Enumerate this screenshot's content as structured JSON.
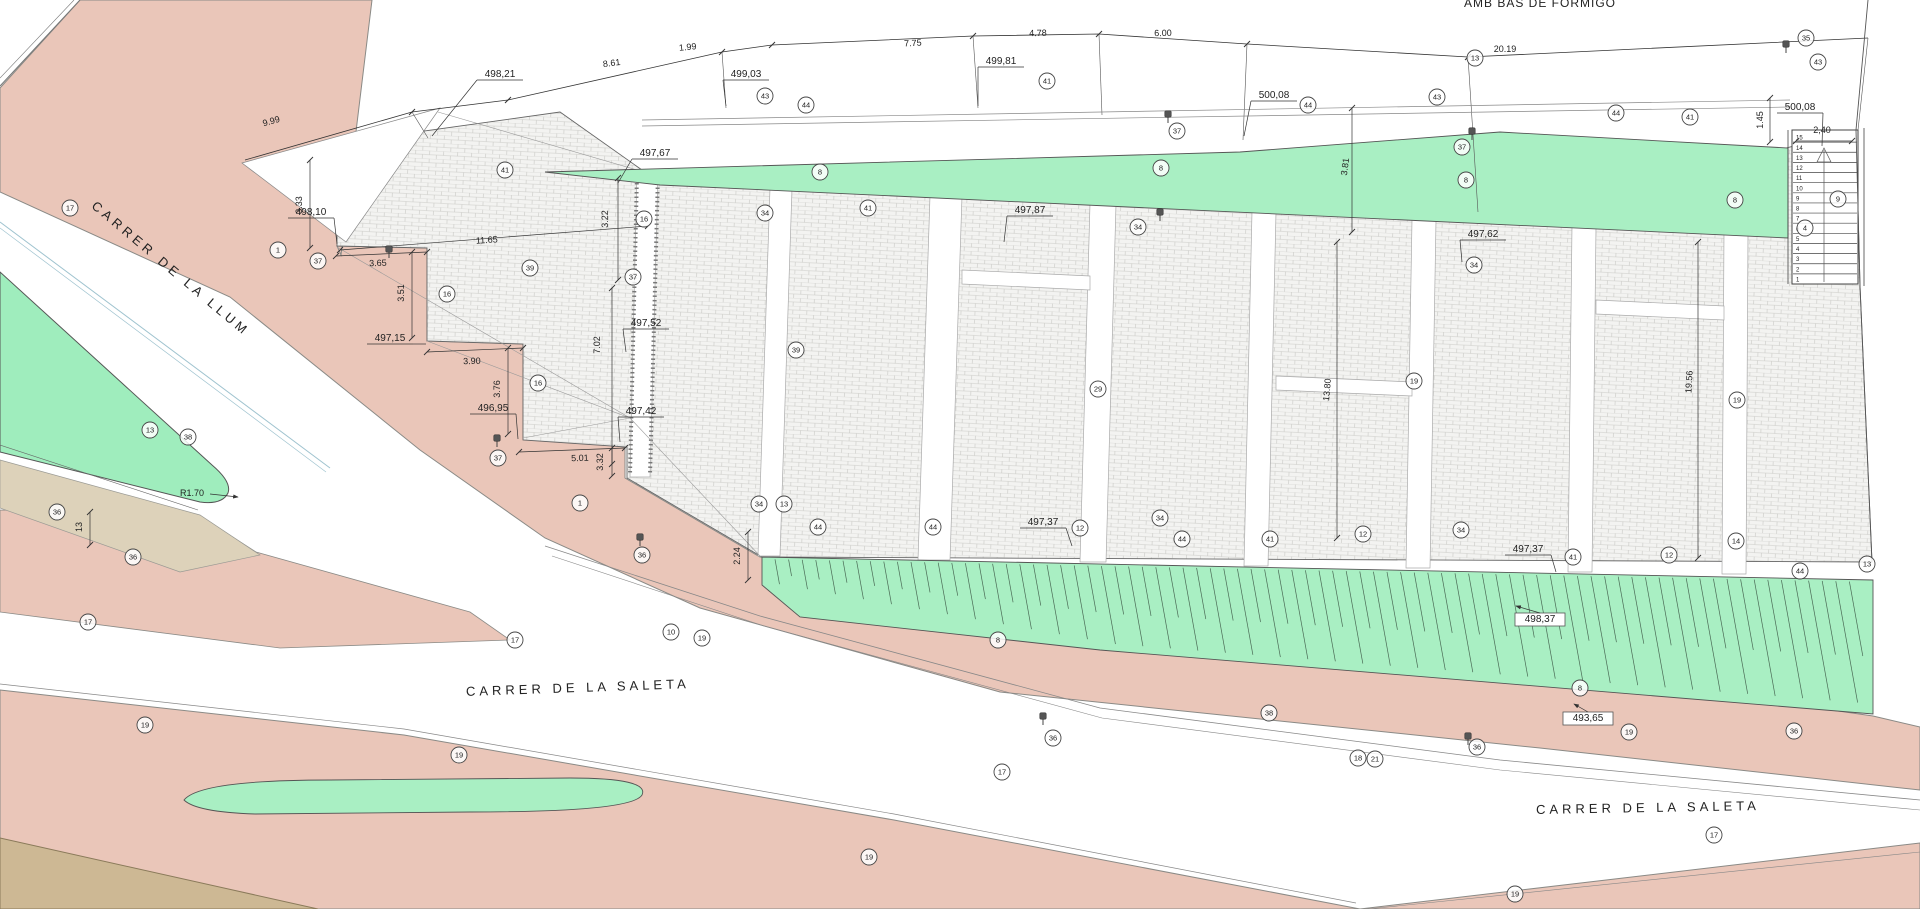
{
  "note_top_right": "AMB BAS DE FORMIGO",
  "radius_label": "R1.70",
  "street_names": [
    {
      "text": "CARRER  DE  LA  LLUM",
      "x": 168,
      "y": 272,
      "rot": 40
    },
    {
      "text": "CARRER  DE  LA  SALETA",
      "x": 578,
      "y": 692,
      "rot": -2
    },
    {
      "text": "CARRER  DE  LA  SALETA",
      "x": 1648,
      "y": 812,
      "rot": -1
    }
  ],
  "dimensions": [
    {
      "t": "9.99",
      "x": 272,
      "y": 124,
      "r": -16
    },
    {
      "t": "8.61",
      "x": 612,
      "y": 66,
      "r": -7
    },
    {
      "t": "1.99",
      "x": 688,
      "y": 50,
      "r": -6
    },
    {
      "t": "7.75",
      "x": 913,
      "y": 46,
      "r": -3
    },
    {
      "t": "4.78",
      "x": 1038,
      "y": 36,
      "r": -1
    },
    {
      "t": "6.00",
      "x": 1163,
      "y": 36,
      "r": -1
    },
    {
      "t": "20.19",
      "x": 1505,
      "y": 52,
      "r": 0
    },
    {
      "t": "3.33",
      "x": 302,
      "y": 205,
      "r": -90,
      "l": [
        310,
        160,
        310,
        248
      ]
    },
    {
      "t": "3.65",
      "x": 378,
      "y": 266,
      "r": -2,
      "l": [
        336,
        256,
        427,
        252
      ]
    },
    {
      "t": "11.65",
      "x": 487,
      "y": 243,
      "r": -4,
      "l": [
        340,
        250,
        648,
        226
      ]
    },
    {
      "t": "3.51",
      "x": 404,
      "y": 293,
      "r": -90,
      "l": [
        412,
        252,
        412,
        338
      ]
    },
    {
      "t": "3.90",
      "x": 472,
      "y": 364,
      "r": -2,
      "l": [
        427,
        352,
        523,
        348
      ]
    },
    {
      "t": "3.76",
      "x": 500,
      "y": 389,
      "r": -90,
      "l": [
        508,
        348,
        508,
        434
      ]
    },
    {
      "t": "5.01",
      "x": 580,
      "y": 461,
      "r": -2,
      "l": [
        519,
        452,
        625,
        448
      ]
    },
    {
      "t": "3.32",
      "x": 603,
      "y": 462,
      "r": -90,
      "l": [
        612,
        448,
        612,
        476
      ]
    },
    {
      "t": "3.22",
      "x": 608,
      "y": 219,
      "r": -90,
      "l": [
        618,
        178,
        618,
        280
      ]
    },
    {
      "t": "7.02",
      "x": 600,
      "y": 345,
      "r": -90,
      "l": [
        612,
        288,
        612,
        464
      ]
    },
    {
      "t": "2.24",
      "x": 740,
      "y": 556,
      "r": -90,
      "l": [
        748,
        532,
        748,
        580
      ]
    },
    {
      "t": "3.81",
      "x": 1348,
      "y": 167,
      "r": -83,
      "l": [
        1352,
        108,
        1352,
        232
      ]
    },
    {
      "t": "13.80",
      "x": 1330,
      "y": 390,
      "r": -85,
      "l": [
        1337,
        242,
        1337,
        538
      ]
    },
    {
      "t": "19.56",
      "x": 1692,
      "y": 382,
      "r": -87,
      "l": [
        1698,
        242,
        1698,
        558
      ]
    },
    {
      "t": "1.45",
      "x": 1763,
      "y": 120,
      "r": -90,
      "l": [
        1770,
        98,
        1770,
        142
      ]
    },
    {
      "t": "2,40",
      "x": 1822,
      "y": 133,
      "r": 0,
      "l": [
        1796,
        141,
        1852,
        141
      ]
    },
    {
      "t": "13",
      "x": 82,
      "y": 527,
      "r": -90,
      "l": [
        90,
        512,
        90,
        545
      ]
    }
  ],
  "elevations": [
    {
      "t": "498,21",
      "x": 500,
      "y": 77,
      "lx": 432,
      "ly": 136
    },
    {
      "t": "499,03",
      "x": 746,
      "y": 77,
      "lx": 726,
      "ly": 106
    },
    {
      "t": "499,81",
      "x": 1001,
      "y": 64,
      "lx": 978,
      "ly": 106
    },
    {
      "t": "500,08",
      "x": 1274,
      "y": 98,
      "lx": 1244,
      "ly": 136
    },
    {
      "t": "500,08",
      "x": 1800,
      "y": 110,
      "lx": 1822,
      "ly": 146
    },
    {
      "t": "498,10",
      "x": 311,
      "y": 215,
      "lx": 337,
      "ly": 244
    },
    {
      "t": "497,15",
      "x": 390,
      "y": 341,
      "lx": 426,
      "ly": 344
    },
    {
      "t": "496,95",
      "x": 493,
      "y": 411,
      "lx": 518,
      "ly": 439
    },
    {
      "t": "497,67",
      "x": 655,
      "y": 156,
      "lx": 618,
      "ly": 183
    },
    {
      "t": "497,52",
      "x": 646,
      "y": 326,
      "lx": 626,
      "ly": 352
    },
    {
      "t": "497,42",
      "x": 641,
      "y": 414,
      "lx": 620,
      "ly": 442
    },
    {
      "t": "497,87",
      "x": 1030,
      "y": 213,
      "lx": 1004,
      "ly": 242
    },
    {
      "t": "497,62",
      "x": 1483,
      "y": 237,
      "lx": 1462,
      "ly": 262
    },
    {
      "t": "497,37",
      "x": 1043,
      "y": 525,
      "lx": 1072,
      "ly": 546
    },
    {
      "t": "497,37",
      "x": 1528,
      "y": 552,
      "lx": 1556,
      "ly": 572
    },
    {
      "t": "498,37",
      "x": 1540,
      "y": 622,
      "lx": 1516,
      "ly": 606,
      "boxed": true
    },
    {
      "t": "493,65",
      "x": 1588,
      "y": 721,
      "lx": 1574,
      "ly": 704,
      "boxed": true
    }
  ],
  "keynotes": [
    {
      "n": "17",
      "x": 70,
      "y": 208
    },
    {
      "n": "17",
      "x": 88,
      "y": 622
    },
    {
      "n": "17",
      "x": 515,
      "y": 640
    },
    {
      "n": "17",
      "x": 1002,
      "y": 772
    },
    {
      "n": "17",
      "x": 1714,
      "y": 835
    },
    {
      "n": "1",
      "x": 278,
      "y": 250
    },
    {
      "n": "1",
      "x": 580,
      "y": 503
    },
    {
      "n": "37",
      "x": 318,
      "y": 261
    },
    {
      "n": "37",
      "x": 498,
      "y": 458
    },
    {
      "n": "37",
      "x": 633,
      "y": 277
    },
    {
      "n": "37",
      "x": 1177,
      "y": 131
    },
    {
      "n": "37",
      "x": 1462,
      "y": 147
    },
    {
      "n": "43",
      "x": 765,
      "y": 96
    },
    {
      "n": "43",
      "x": 1437,
      "y": 97
    },
    {
      "n": "43",
      "x": 1818,
      "y": 62
    },
    {
      "n": "44",
      "x": 806,
      "y": 105
    },
    {
      "n": "44",
      "x": 1308,
      "y": 105
    },
    {
      "n": "44",
      "x": 1616,
      "y": 113
    },
    {
      "n": "44",
      "x": 818,
      "y": 527
    },
    {
      "n": "44",
      "x": 933,
      "y": 527
    },
    {
      "n": "44",
      "x": 1182,
      "y": 539
    },
    {
      "n": "44",
      "x": 1800,
      "y": 571
    },
    {
      "n": "41",
      "x": 505,
      "y": 170
    },
    {
      "n": "41",
      "x": 1047,
      "y": 81
    },
    {
      "n": "41",
      "x": 1690,
      "y": 117
    },
    {
      "n": "41",
      "x": 868,
      "y": 208
    },
    {
      "n": "41",
      "x": 1270,
      "y": 539
    },
    {
      "n": "41",
      "x": 1573,
      "y": 557
    },
    {
      "n": "16",
      "x": 447,
      "y": 294
    },
    {
      "n": "16",
      "x": 538,
      "y": 383
    },
    {
      "n": "16",
      "x": 644,
      "y": 219
    },
    {
      "n": "39",
      "x": 530,
      "y": 268
    },
    {
      "n": "39",
      "x": 796,
      "y": 350
    },
    {
      "n": "29",
      "x": 1098,
      "y": 389
    },
    {
      "n": "19",
      "x": 1414,
      "y": 381
    },
    {
      "n": "19",
      "x": 1737,
      "y": 400
    },
    {
      "n": "19",
      "x": 145,
      "y": 725
    },
    {
      "n": "19",
      "x": 459,
      "y": 755
    },
    {
      "n": "19",
      "x": 702,
      "y": 638
    },
    {
      "n": "19",
      "x": 869,
      "y": 857
    },
    {
      "n": "19",
      "x": 1629,
      "y": 732
    },
    {
      "n": "19",
      "x": 1515,
      "y": 894
    },
    {
      "n": "13",
      "x": 1475,
      "y": 58
    },
    {
      "n": "13",
      "x": 784,
      "y": 504
    },
    {
      "n": "13",
      "x": 1867,
      "y": 564
    },
    {
      "n": "13",
      "x": 150,
      "y": 430
    },
    {
      "n": "8",
      "x": 820,
      "y": 172
    },
    {
      "n": "8",
      "x": 1161,
      "y": 168
    },
    {
      "n": "8",
      "x": 1466,
      "y": 180
    },
    {
      "n": "8",
      "x": 1735,
      "y": 200
    },
    {
      "n": "8",
      "x": 998,
      "y": 640
    },
    {
      "n": "8",
      "x": 1580,
      "y": 688
    },
    {
      "n": "34",
      "x": 759,
      "y": 504
    },
    {
      "n": "34",
      "x": 1160,
      "y": 518
    },
    {
      "n": "34",
      "x": 1461,
      "y": 530
    },
    {
      "n": "34",
      "x": 765,
      "y": 213
    },
    {
      "n": "34",
      "x": 1138,
      "y": 227
    },
    {
      "n": "34",
      "x": 1474,
      "y": 265
    },
    {
      "n": "12",
      "x": 1080,
      "y": 528
    },
    {
      "n": "12",
      "x": 1363,
      "y": 534
    },
    {
      "n": "12",
      "x": 1669,
      "y": 555
    },
    {
      "n": "14",
      "x": 1736,
      "y": 541
    },
    {
      "n": "36",
      "x": 1053,
      "y": 738
    },
    {
      "n": "36",
      "x": 1477,
      "y": 747
    },
    {
      "n": "36",
      "x": 1794,
      "y": 731
    },
    {
      "n": "36",
      "x": 642,
      "y": 555
    },
    {
      "n": "36",
      "x": 57,
      "y": 512
    },
    {
      "n": "36",
      "x": 133,
      "y": 557
    },
    {
      "n": "38",
      "x": 1269,
      "y": 713
    },
    {
      "n": "38",
      "x": 188,
      "y": 437
    },
    {
      "n": "18",
      "x": 1358,
      "y": 758
    },
    {
      "n": "21",
      "x": 1375,
      "y": 759
    },
    {
      "n": "10",
      "x": 671,
      "y": 632
    },
    {
      "n": "35",
      "x": 1806,
      "y": 38
    },
    {
      "n": "9",
      "x": 1838,
      "y": 199
    },
    {
      "n": "4",
      "x": 1805,
      "y": 228
    }
  ],
  "markers": [
    {
      "x": 389,
      "y": 249
    },
    {
      "x": 497,
      "y": 438
    },
    {
      "x": 1168,
      "y": 114
    },
    {
      "x": 1472,
      "y": 131
    },
    {
      "x": 1786,
      "y": 44
    },
    {
      "x": 1043,
      "y": 716
    },
    {
      "x": 1468,
      "y": 736
    },
    {
      "x": 1160,
      "y": 212
    },
    {
      "x": 640,
      "y": 537
    }
  ],
  "stairs": {
    "tread_count": 15,
    "dim_label": "2,40",
    "elev_label": "500,08"
  },
  "colors": {
    "sidewalk_pink": "#eac6b9",
    "green": "#a9efc3",
    "green_island": "#9fedbd",
    "tan": "#ddd2ba",
    "corner_tan": "#cdb894",
    "paving_bg": "#f3f3f1",
    "brick_line": "#c9c9c5",
    "line_dark": "#444",
    "line_mid": "#777",
    "survey_cyan": "#9fc3cf"
  }
}
